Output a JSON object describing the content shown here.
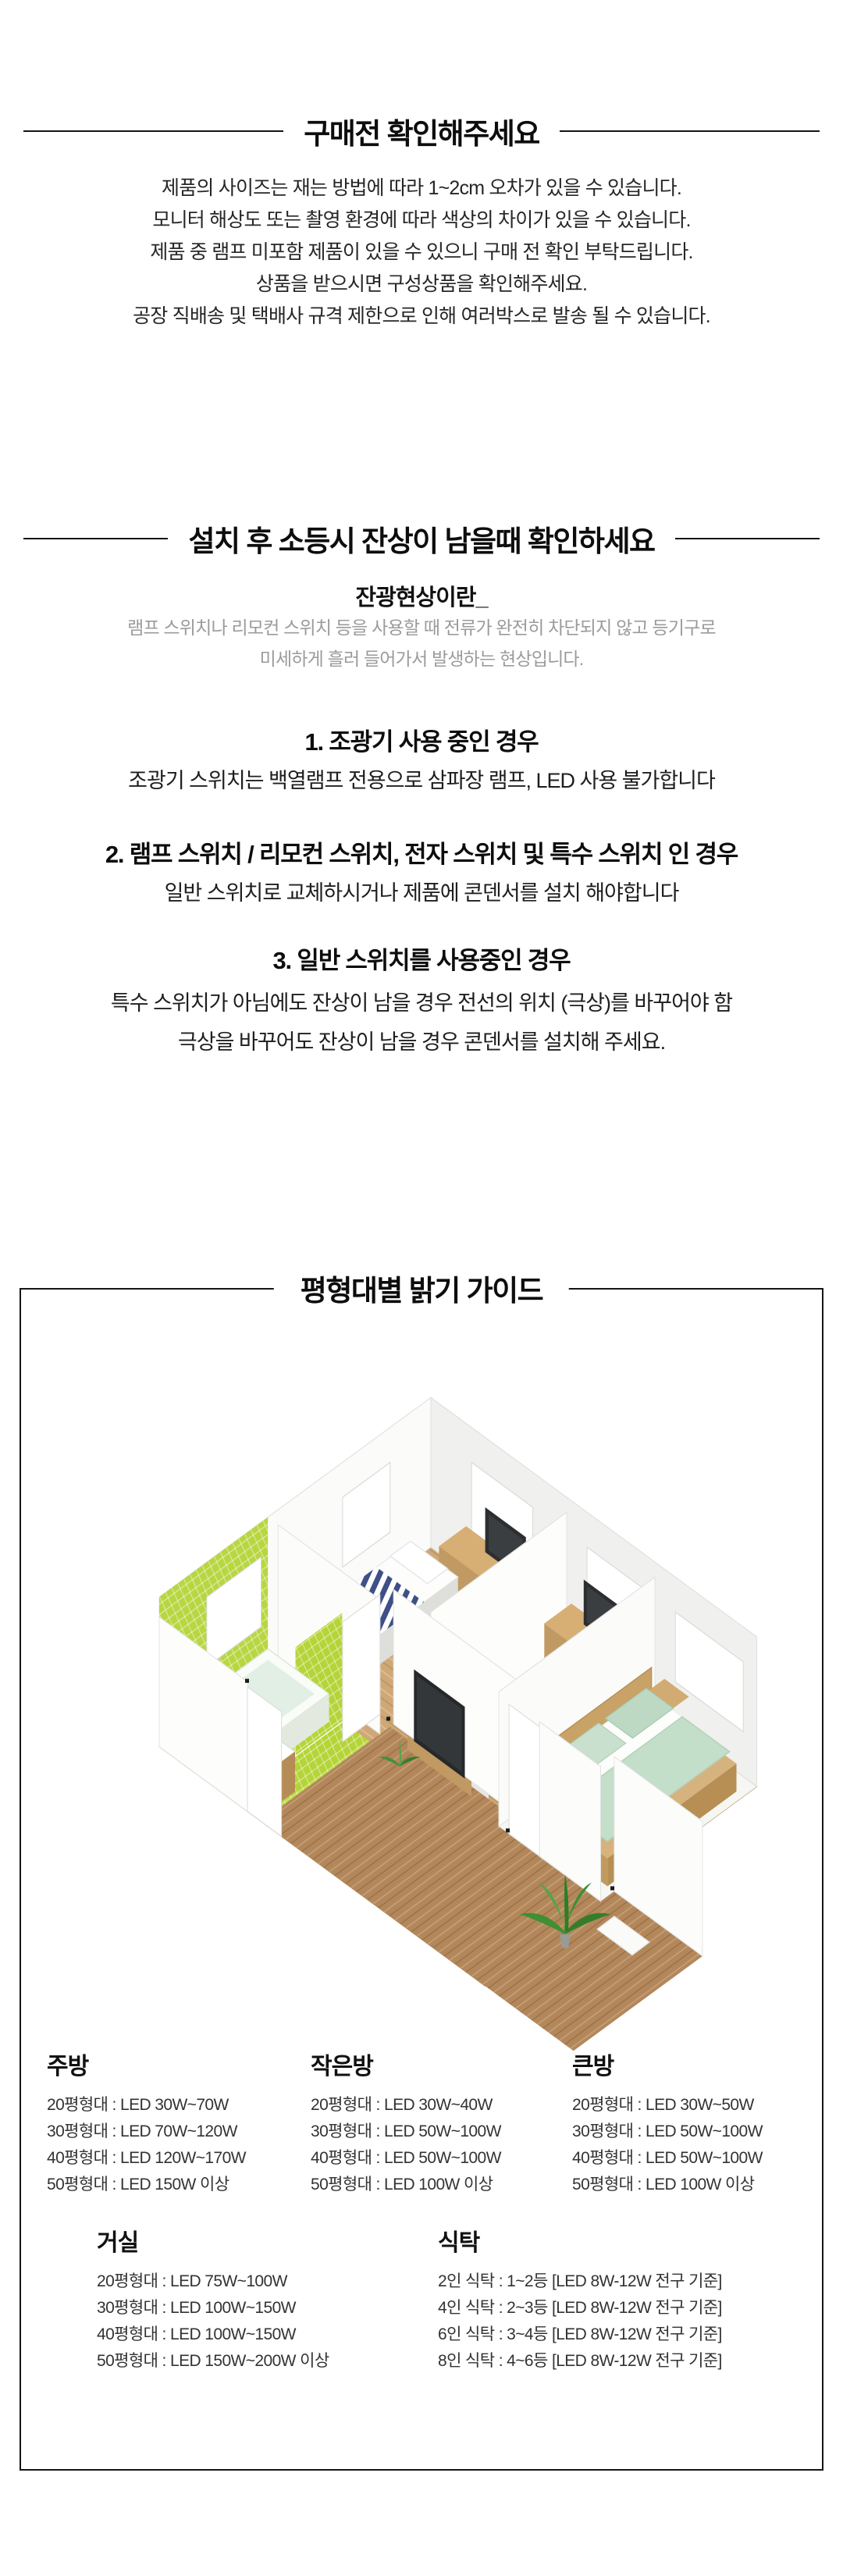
{
  "section1": {
    "title": "구매전 확인해주세요",
    "lines": [
      "제품의 사이즈는 재는 방법에 따라 1~2cm 오차가 있을 수 있습니다.",
      "모니터 해상도 또는 촬영 환경에 따라 색상의 차이가 있을 수 있습니다.",
      "제품 중 램프 미포함 제품이 있을 수 있으니 구매 전 확인 부탁드립니다.",
      "상품을 받으시면 구성상품을 확인해주세요.",
      "공장 직배송 및 택배사 규격 제한으로 인해 여러박스로 발송 될 수 있습니다."
    ]
  },
  "section2": {
    "title": "설치 후 소등시 잔상이 남을때 확인하세요",
    "subtitle": "잔광현상이란_",
    "desc": [
      "램프 스위치나 리모컨 스위치 등을 사용할 때 전류가 완전히 차단되지 않고 등기구로",
      "미세하게 흘러 들어가서 발생하는 현상입니다."
    ],
    "cases": [
      {
        "heading": "1. 조광기 사용 중인 경우",
        "lines": [
          "조광기 스위치는 백열램프 전용으로 삼파장 램프, LED 사용 불가합니다"
        ]
      },
      {
        "heading": "2. 램프 스위치 / 리모컨 스위치, 전자 스위치 및 특수 스위치 인 경우",
        "lines": [
          "일반 스위치로 교체하시거나 제품에 콘덴서를 설치 해야합니다"
        ]
      },
      {
        "heading": "3. 일반 스위치를 사용중인 경우",
        "lines": [
          "특수 스위치가 아님에도 잔상이 남을 경우 전선의 위치 (극상)를 바꾸어야 함",
          "극상을 바꾸어도 잔상이 남을 경우 콘덴서를 설치해 주세요."
        ]
      }
    ]
  },
  "guide": {
    "title": "평형대별 밝기 가이드",
    "rooms_row1": [
      {
        "name": "주방",
        "items": [
          "20평형대 : LED 30W~70W",
          "30평형대 : LED 70W~120W",
          "40평형대 : LED 120W~170W",
          "50평형대 : LED 150W 이상"
        ]
      },
      {
        "name": "작은방",
        "items": [
          "20평형대 : LED 30W~40W",
          "30평형대 : LED 50W~100W",
          "40평형대 : LED 50W~100W",
          "50평형대 : LED 100W 이상"
        ]
      },
      {
        "name": "큰방",
        "items": [
          "20평형대 : LED 30W~50W",
          "30평형대 : LED 50W~100W",
          "40평형대 : LED 50W~100W",
          "50평형대 : LED 100W 이상"
        ]
      }
    ],
    "rooms_row2": [
      {
        "name": "거실",
        "items": [
          "20평형대 : LED 75W~100W",
          "30평형대 : LED 100W~150W",
          "40평형대 : LED 100W~150W",
          "50평형대 : LED 150W~200W 이상"
        ]
      },
      {
        "name": "식탁",
        "items": [
          "2인 식탁 : 1~2등 [LED 8W-12W 전구 기준]",
          "4인 식탁 : 2~3등 [LED 8W-12W 전구 기준]",
          "6인 식탁 : 3~4등 [LED 8W-12W 전구 기준]",
          "8인 식탁 : 4~6등 [LED 8W-12W 전구 기준]"
        ]
      }
    ],
    "floorplan": {
      "description": "isometric-apartment-floorplan",
      "colors": {
        "wood_floor": "#cfa876",
        "hallway_wood": "#b3875a",
        "bathroom_tile": "#b5d438",
        "stripe_navy": "#3e5086",
        "duvet_sage": "#c3dec9",
        "wall_white": "#fdfdfd"
      }
    }
  }
}
